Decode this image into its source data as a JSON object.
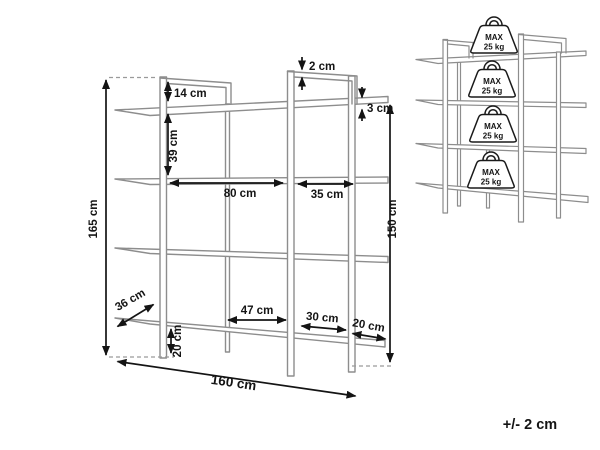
{
  "colors": {
    "line_gray": "#8d8d8d",
    "ink": "#141414",
    "background": "#ffffff"
  },
  "main_view": {
    "labels": {
      "overall_height": "165 cm",
      "top_frame_height": "14 cm",
      "shelf_gap": "39 cm",
      "frame_thickness": "2 cm",
      "shelf_thickness": "3 cm",
      "left_bay_width": "80 cm",
      "right_bay_width": "35 cm",
      "right_height": "150 cm",
      "shelf_depth": "36 cm",
      "bottom_span_left": "47 cm",
      "bottom_span_mid": "30 cm",
      "bottom_span_right": "20 cm",
      "leg_height": "20 cm",
      "overall_width": "160 cm"
    }
  },
  "load_view": {
    "weights": [
      {
        "line1": "MAX",
        "line2": "25 kg"
      },
      {
        "line1": "MAX",
        "line2": "25 kg"
      },
      {
        "line1": "MAX",
        "line2": "25 kg"
      },
      {
        "line1": "MAX",
        "line2": "25 kg"
      }
    ]
  },
  "footer": {
    "tolerance": "+/- 2 cm"
  }
}
